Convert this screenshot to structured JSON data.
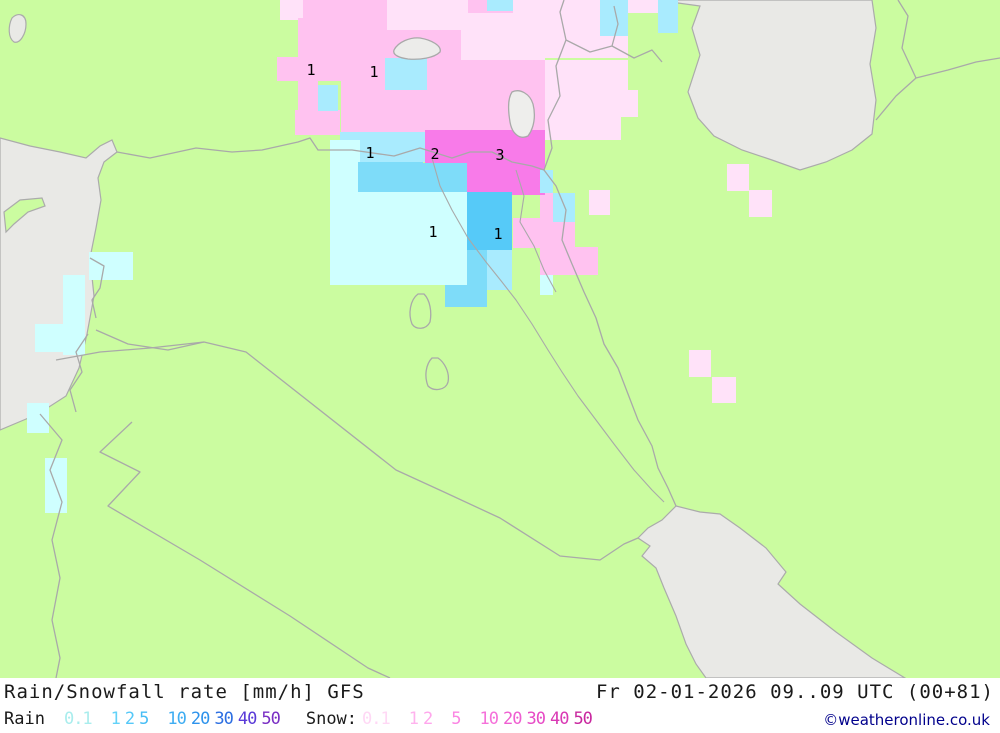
{
  "header": {
    "title": "Rain/Snowfall rate [mm/h] GFS",
    "datetime": "Fr 02-01-2026 09..09 UTC (00+81)"
  },
  "legend": {
    "rain_label": "Rain",
    "rain_scale": [
      {
        "v": "0.1",
        "c": "#a9eded",
        "g": true
      },
      {
        "v": "1",
        "c": "#63d2f8",
        "g": true
      },
      {
        "v": "2",
        "c": "#55c8f8",
        "g": false
      },
      {
        "v": "5",
        "c": "#49bef5",
        "g": false
      },
      {
        "v": "10",
        "c": "#3fadf2",
        "g": true
      },
      {
        "v": "20",
        "c": "#2e93ec",
        "g": false
      },
      {
        "v": "30",
        "c": "#2d6fe2",
        "g": false
      },
      {
        "v": "40",
        "c": "#5a3bd8",
        "g": false
      },
      {
        "v": "50",
        "c": "#7a2fc4",
        "g": false
      }
    ],
    "snow_label": "Snow:",
    "snow_scale": [
      {
        "v": "0.1",
        "c": "#ffd8f5",
        "g": false
      },
      {
        "v": "1",
        "c": "#ffb3ee",
        "g": true
      },
      {
        "v": "2",
        "c": "#ffa6ec",
        "g": false
      },
      {
        "v": "5",
        "c": "#fb85e3",
        "g": true
      },
      {
        "v": "10",
        "c": "#f571da",
        "g": true
      },
      {
        "v": "20",
        "c": "#ef5ed1",
        "g": false
      },
      {
        "v": "30",
        "c": "#e74cc6",
        "g": false
      },
      {
        "v": "40",
        "c": "#d939b4",
        "g": false
      },
      {
        "v": "50",
        "c": "#c9289f",
        "g": false
      }
    ]
  },
  "credit": "©weatheronline.co.uk",
  "colors": {
    "land": "#cbfca0",
    "sea": "#e9e9e6",
    "border": "#a9a9a9",
    "credit": "#00008b"
  },
  "palette": {
    "s01": "#ffe2f9",
    "s1": "#ffc2f0",
    "s2": "#f87be9",
    "r01": "#cfffff",
    "r1l": "#a9ebfe",
    "r1m": "#7edcf9",
    "r2": "#56caf8"
  },
  "map": {
    "cells": [
      [
        280,
        0,
        23,
        20,
        "s01"
      ],
      [
        303,
        0,
        84,
        30,
        "s1"
      ],
      [
        387,
        0,
        81,
        35,
        "s01"
      ],
      [
        468,
        0,
        45,
        13,
        "s1"
      ],
      [
        513,
        0,
        55,
        33,
        "s01"
      ],
      [
        568,
        0,
        33,
        13,
        "s01"
      ],
      [
        628,
        0,
        50,
        13,
        "s01"
      ],
      [
        545,
        13,
        83,
        45,
        "s01"
      ],
      [
        461,
        13,
        84,
        47,
        "s01"
      ],
      [
        298,
        18,
        43,
        40,
        "s1"
      ],
      [
        277,
        57,
        64,
        24,
        "s1"
      ],
      [
        298,
        80,
        20,
        55,
        "s1"
      ],
      [
        295,
        110,
        45,
        25,
        "s1"
      ],
      [
        341,
        30,
        120,
        60,
        "s1"
      ],
      [
        341,
        90,
        104,
        45,
        "s1"
      ],
      [
        445,
        60,
        100,
        75,
        "s1"
      ],
      [
        545,
        60,
        83,
        30,
        "s01"
      ],
      [
        545,
        90,
        76,
        50,
        "s01"
      ],
      [
        600,
        90,
        38,
        27,
        "s01"
      ],
      [
        513,
        130,
        32,
        38,
        "s1"
      ],
      [
        540,
        193,
        13,
        29,
        "s1"
      ],
      [
        513,
        218,
        27,
        30,
        "s1"
      ],
      [
        540,
        222,
        35,
        25,
        "s1"
      ],
      [
        540,
        247,
        58,
        28,
        "s1"
      ],
      [
        589,
        190,
        21,
        25,
        "s01"
      ],
      [
        727,
        164,
        22,
        27,
        "s01"
      ],
      [
        749,
        190,
        23,
        27,
        "s01"
      ],
      [
        689,
        350,
        22,
        27,
        "s01"
      ],
      [
        712,
        377,
        24,
        26,
        "s01"
      ],
      [
        425,
        130,
        120,
        33,
        "s2"
      ],
      [
        458,
        163,
        87,
        32,
        "s2"
      ],
      [
        487,
        0,
        26,
        11,
        "r1l"
      ],
      [
        600,
        0,
        28,
        36,
        "r1l"
      ],
      [
        658,
        0,
        20,
        33,
        "r1l"
      ],
      [
        318,
        85,
        20,
        26,
        "r1l"
      ],
      [
        385,
        58,
        42,
        32,
        "r1l"
      ],
      [
        340,
        132,
        85,
        30,
        "r1l"
      ],
      [
        330,
        140,
        30,
        75,
        "r01"
      ],
      [
        358,
        162,
        65,
        30,
        "r1m"
      ],
      [
        423,
        163,
        44,
        34,
        "r1m"
      ],
      [
        330,
        192,
        137,
        93,
        "r01"
      ],
      [
        467,
        192,
        45,
        58,
        "r2"
      ],
      [
        467,
        250,
        45,
        35,
        "r1m"
      ],
      [
        445,
        285,
        42,
        22,
        "r1m"
      ],
      [
        412,
        250,
        55,
        35,
        "r01"
      ],
      [
        487,
        250,
        25,
        40,
        "r1l"
      ],
      [
        540,
        170,
        13,
        23,
        "r1l"
      ],
      [
        553,
        193,
        22,
        29,
        "r1l"
      ],
      [
        540,
        275,
        13,
        20,
        "r01"
      ],
      [
        89,
        252,
        44,
        28,
        "r01"
      ],
      [
        63,
        275,
        22,
        80,
        "r01"
      ],
      [
        35,
        324,
        47,
        28,
        "r01"
      ],
      [
        27,
        403,
        22,
        30,
        "r01"
      ],
      [
        45,
        458,
        22,
        55,
        "r01"
      ]
    ],
    "labels": [
      {
        "t": "1",
        "x": 311,
        "y": 70
      },
      {
        "t": "1",
        "x": 374,
        "y": 72
      },
      {
        "t": "1",
        "x": 370,
        "y": 153
      },
      {
        "t": "2",
        "x": 435,
        "y": 154
      },
      {
        "t": "3",
        "x": 500,
        "y": 155
      },
      {
        "t": "1",
        "x": 433,
        "y": 232
      },
      {
        "t": "1",
        "x": 498,
        "y": 234
      }
    ]
  }
}
